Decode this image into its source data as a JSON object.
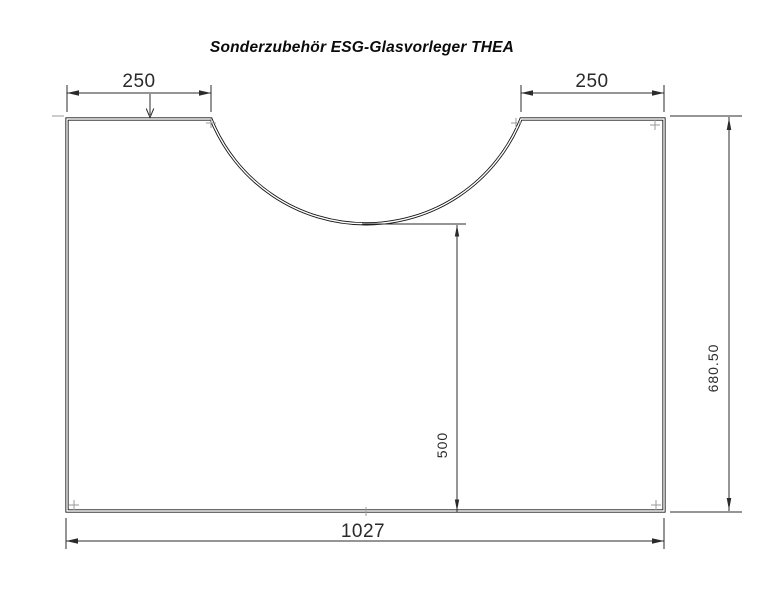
{
  "title": "Sonderzubehör ESG-Glasvorleger THEA",
  "dimensions": {
    "top_left_width": "250",
    "top_right_width": "250",
    "overall_width": "1027",
    "cutout_to_bottom_height": "500",
    "overall_height": "680.50"
  },
  "colors": {
    "background": "#ffffff",
    "outline": "#151515",
    "dimension_lines": "#2b2b2b",
    "dimension_text": "#2a2a2a",
    "title_text": "#0b0b0b"
  }
}
